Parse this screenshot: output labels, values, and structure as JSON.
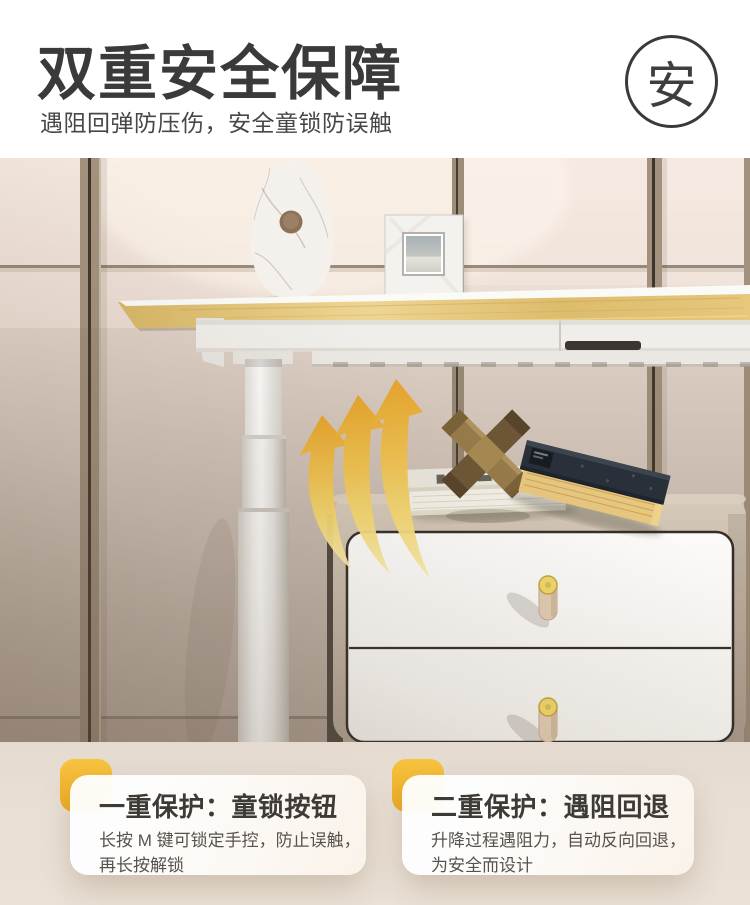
{
  "header": {
    "title": "双重安全保障",
    "subtitle": "遇阻回弹防压伤，安全童锁防误触",
    "badge": "安"
  },
  "cards": [
    {
      "title": "一重保护：童锁按钮",
      "line1": "长按 M 键可锁定手控，防止误触，",
      "line2": "再长按解锁"
    },
    {
      "title": "二重保护：遇阻回退",
      "line1": "升降过程遇阻力，自动反向回退，",
      "line2": "为安全而设计"
    }
  ],
  "colors": {
    "accent_yellow": "#F2B42D",
    "arrow_gold": "#E9A92C",
    "title_text": "#3A3A3A",
    "subtitle_text": "#474747",
    "card_title_text": "#3E3A35",
    "card_body_text": "#57524C",
    "bottom_band": "#E7DDD2",
    "desk_wood": "#E0C276",
    "cabinet_taupe": "#BDAF9E"
  },
  "scene": {
    "objects": [
      "marble-vase",
      "photo-frame",
      "lift-desk-top",
      "telescoping-desk-leg",
      "upward-motion-arrows",
      "drawer-cabinet",
      "leather-drawer-handles",
      "white-book",
      "navy-book",
      "wooden-cross-puzzle"
    ]
  }
}
